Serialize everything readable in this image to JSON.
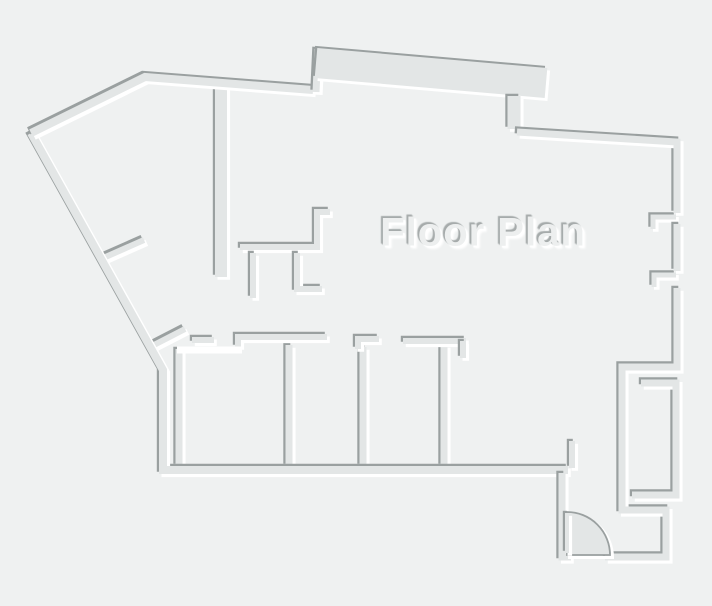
{
  "title": {
    "text": "Floor Plan"
  },
  "canvas": {
    "width": 712,
    "height": 606,
    "background": "#eff1f1"
  },
  "colors": {
    "wall_body": "#e3e6e6",
    "wall_shadow": "#9aa0a0",
    "wall_highlight": "#ffffff",
    "door_fill": "#e3e6e6",
    "door_stroke": "#9aa0a0",
    "title_fill": "#edefef"
  },
  "emboss": {
    "shadow_dx": -2.2,
    "shadow_dy": -2.2,
    "highlight_dx": 2.8,
    "highlight_dy": 2.8
  },
  "floorplan": {
    "walls": [
      {
        "name": "column-wall-left-of-kitchen",
        "style": "emboss",
        "w": 12,
        "points": [
          [
            221,
            85
          ],
          [
            221,
            277
          ]
        ]
      },
      {
        "name": "kitchen-nook-upper",
        "style": "emboss",
        "w": 6,
        "points": [
          [
            330,
            212
          ],
          [
            317,
            212
          ],
          [
            317,
            247
          ],
          [
            240,
            247
          ]
        ]
      },
      {
        "name": "kitchen-nook-post-a",
        "style": "emboss",
        "w": 6,
        "points": [
          [
            253,
            253
          ],
          [
            253,
            298
          ]
        ]
      },
      {
        "name": "kitchen-nook-lower",
        "style": "emboss",
        "w": 6,
        "points": [
          [
            297,
            253
          ],
          [
            297,
            289
          ],
          [
            322,
            289
          ]
        ]
      },
      {
        "name": "left-diagonal-stub-upper",
        "style": "emboss",
        "w": 6,
        "points": [
          [
            101,
            259
          ],
          [
            144,
            240
          ]
        ]
      },
      {
        "name": "left-diagonal-stub-lower",
        "style": "emboss",
        "w": 6,
        "points": [
          [
            152,
            346
          ],
          [
            185,
            329
          ]
        ]
      },
      {
        "name": "left-horizontal-stub",
        "style": "emboss",
        "w": 6,
        "points": [
          [
            192,
            340
          ],
          [
            214,
            340
          ]
        ]
      },
      {
        "name": "room-divider-0",
        "style": "emboss",
        "w": 7,
        "points": [
          [
            179,
            349
          ],
          [
            179,
            466
          ]
        ]
      },
      {
        "name": "room-divider-1",
        "style": "emboss",
        "w": 7,
        "points": [
          [
            289,
            345
          ],
          [
            289,
            466
          ]
        ]
      },
      {
        "name": "room-divider-2",
        "style": "emboss",
        "w": 7,
        "points": [
          [
            363,
            347
          ],
          [
            363,
            466
          ]
        ]
      },
      {
        "name": "room-divider-3",
        "style": "emboss",
        "w": 7,
        "points": [
          [
            444,
            345
          ],
          [
            444,
            466
          ]
        ]
      },
      {
        "name": "rooms-top-wall-west",
        "style": "emboss",
        "w": 6,
        "points": [
          [
            238,
            347
          ],
          [
            238,
            337
          ],
          [
            327,
            337
          ]
        ]
      },
      {
        "name": "rooms-top-wall-mid",
        "style": "emboss",
        "w": 6,
        "points": [
          [
            358,
            349
          ],
          [
            358,
            339
          ],
          [
            379,
            339
          ]
        ]
      },
      {
        "name": "rooms-top-wall-east",
        "style": "emboss",
        "w": 6,
        "points": [
          [
            403,
            341
          ],
          [
            466,
            341
          ]
        ]
      },
      {
        "name": "rooms-top-wall-east-tab",
        "style": "emboss",
        "w": 6,
        "points": [
          [
            463,
            341
          ],
          [
            463,
            358
          ]
        ]
      },
      {
        "name": "rooms-top-white-ledge",
        "style": "white",
        "w": 7,
        "points": [
          [
            177,
            350
          ],
          [
            242,
            350
          ]
        ]
      },
      {
        "name": "entry-stub-upper",
        "style": "emboss",
        "w": 6,
        "points": [
          [
            572,
            441
          ],
          [
            572,
            468
          ]
        ]
      },
      {
        "name": "closet-nook-right",
        "style": "emboss",
        "w": 7,
        "points": [
          [
            641,
            383
          ],
          [
            676,
            383
          ],
          [
            676,
            495
          ],
          [
            632,
            495
          ]
        ]
      },
      {
        "name": "right-window-hook-1",
        "style": "emboss",
        "w": 5,
        "points": [
          [
            676,
            217
          ],
          [
            653,
            217
          ],
          [
            653,
            229
          ]
        ]
      },
      {
        "name": "right-window-hook-2",
        "style": "emboss",
        "w": 5,
        "points": [
          [
            676,
            275
          ],
          [
            654,
            275
          ],
          [
            654,
            287
          ]
        ]
      },
      {
        "name": "right-wall-between-windows",
        "style": "emboss",
        "w": 7,
        "points": [
          [
            677,
            224
          ],
          [
            677,
            271
          ]
        ]
      },
      {
        "name": "perimeter-left-and-bottom",
        "style": "emboss",
        "w": 8,
        "points": [
          [
            31,
            133
          ],
          [
            163,
            370
          ],
          [
            163,
            470
          ],
          [
            568,
            470
          ]
        ]
      },
      {
        "name": "perimeter-top-left-diagonal",
        "style": "emboss",
        "w": 8,
        "points": [
          [
            31,
            133
          ],
          [
            145,
            77
          ],
          [
            313,
            90
          ]
        ]
      },
      {
        "name": "perimeter-top-jog",
        "style": "emboss",
        "w": 7,
        "points": [
          [
            316,
            92
          ],
          [
            318,
            49
          ]
        ]
      },
      {
        "name": "perimeter-top-thick-band",
        "style": "emboss",
        "w": 30,
        "points": [
          [
            316,
            63
          ],
          [
            546,
            83
          ]
        ]
      },
      {
        "name": "perimeter-band-stub",
        "style": "emboss",
        "w": 13,
        "points": [
          [
            514,
            96
          ],
          [
            514,
            129
          ]
        ]
      },
      {
        "name": "perimeter-top-right",
        "style": "emboss",
        "w": 7,
        "points": [
          [
            517,
            132
          ],
          [
            677,
            142
          ],
          [
            677,
            213
          ]
        ]
      },
      {
        "name": "perimeter-right-lower",
        "style": "emboss",
        "w": 7,
        "points": [
          [
            677,
            288
          ],
          [
            677,
            367
          ],
          [
            622,
            367
          ],
          [
            622,
            510
          ],
          [
            666,
            510
          ],
          [
            666,
            557
          ],
          [
            605,
            557
          ]
        ]
      },
      {
        "name": "entry-left-wall",
        "style": "emboss",
        "w": 7,
        "points": [
          [
            562,
            473
          ],
          [
            562,
            557
          ],
          [
            571,
            557
          ]
        ]
      }
    ],
    "door": {
      "disc": {
        "cx": 567,
        "cy": 555,
        "r": 43
      },
      "leaf": {
        "name": "door-leaf",
        "w": 4,
        "points": [
          [
            567,
            513
          ],
          [
            567,
            553
          ]
        ]
      }
    }
  }
}
